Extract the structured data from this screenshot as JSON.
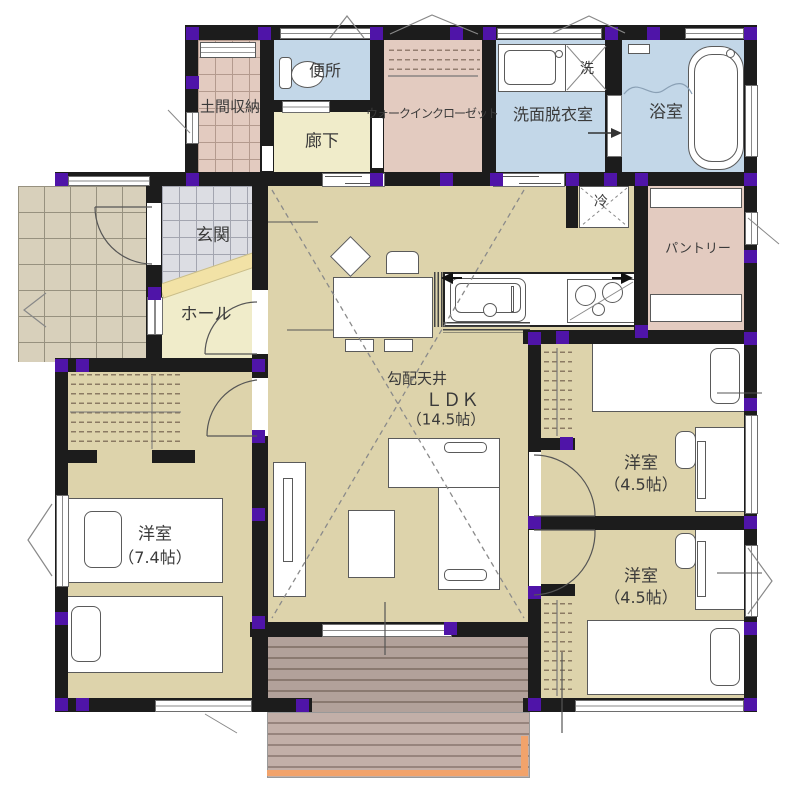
{
  "plan": {
    "title": "1F floor plan",
    "rooms": {
      "doma_storage": "土間収納",
      "toilet": "便所",
      "corridor": "廊下",
      "walk_in_closet": "ウォークインクローゼット",
      "washroom": "洗面脱衣室",
      "washer": "洗",
      "bathroom": "浴室",
      "entrance": "玄関",
      "hall": "ホール",
      "refrigerator": "冷",
      "pantry": "パントリー",
      "ldk_note": "勾配天井",
      "ldk": "ＬＤＫ",
      "ldk_size": "（14.5帖）",
      "bedroom_west": "洋室",
      "bedroom_west_size": "（7.4帖）",
      "bedroom_ne": "洋室",
      "bedroom_ne_size": "（4.5帖）",
      "bedroom_se": "洋室",
      "bedroom_se_size": "（4.5帖）"
    },
    "colors": {
      "wall": "#1c1c1c",
      "post_marker": "#4f14a8",
      "wet_room_blue": "#c3d7e8",
      "wood_floor": "#ddd3ab",
      "storage_pink": "#e3cbc0",
      "hall_cream": "#f0ecca",
      "entrance_tile_gray": "#dcdde3",
      "porch_tile_tan": "#d8d0bb",
      "deck_brown": "#b2a19a",
      "deck_edge_orange": "#f2a36b",
      "step_yellow": "#f2e2a6"
    }
  }
}
